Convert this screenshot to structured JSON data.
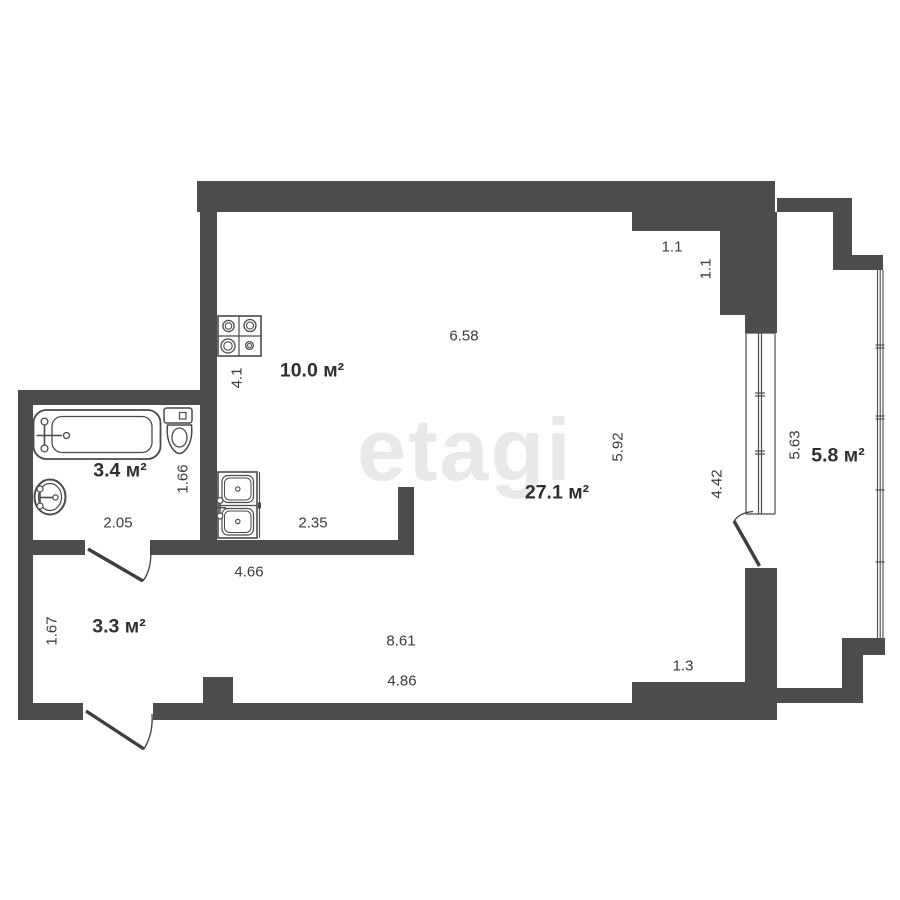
{
  "watermark": {
    "text": "etagi",
    "color": "#e9e9eb"
  },
  "plan": {
    "rooms": [
      {
        "name": "bathroom",
        "area_label": "3.4 м²"
      },
      {
        "name": "kitchen",
        "area_label": "10.0 м²"
      },
      {
        "name": "living-room",
        "area_label": "27.1 м²"
      },
      {
        "name": "balcony",
        "area_label": "5.8 м²"
      },
      {
        "name": "hallway",
        "area_label": "3.3 м²"
      }
    ],
    "dimensions": [
      {
        "text": "6.58",
        "orientation": "horizontal"
      },
      {
        "text": "1.1",
        "orientation": "horizontal"
      },
      {
        "text": "1.1",
        "orientation": "vertical"
      },
      {
        "text": "4.1",
        "orientation": "vertical"
      },
      {
        "text": "5.92",
        "orientation": "vertical"
      },
      {
        "text": "5.63",
        "orientation": "vertical"
      },
      {
        "text": "4.42",
        "orientation": "vertical"
      },
      {
        "text": "1.66",
        "orientation": "vertical"
      },
      {
        "text": "2.05",
        "orientation": "horizontal"
      },
      {
        "text": "2.35",
        "orientation": "horizontal"
      },
      {
        "text": "4.66",
        "orientation": "horizontal"
      },
      {
        "text": "1.67",
        "orientation": "vertical"
      },
      {
        "text": "8.61",
        "orientation": "horizontal"
      },
      {
        "text": "4.86",
        "orientation": "horizontal"
      },
      {
        "text": "1.3",
        "orientation": "horizontal"
      }
    ],
    "fixtures": [
      "bathtub-icon",
      "toilet-icon",
      "bathroom-sink-icon",
      "stove-icon",
      "kitchen-sink-icon"
    ],
    "colors": {
      "wall": "#4c4c4e",
      "line": "#454547",
      "label": "#2f2f31",
      "background": "#ffffff"
    }
  }
}
